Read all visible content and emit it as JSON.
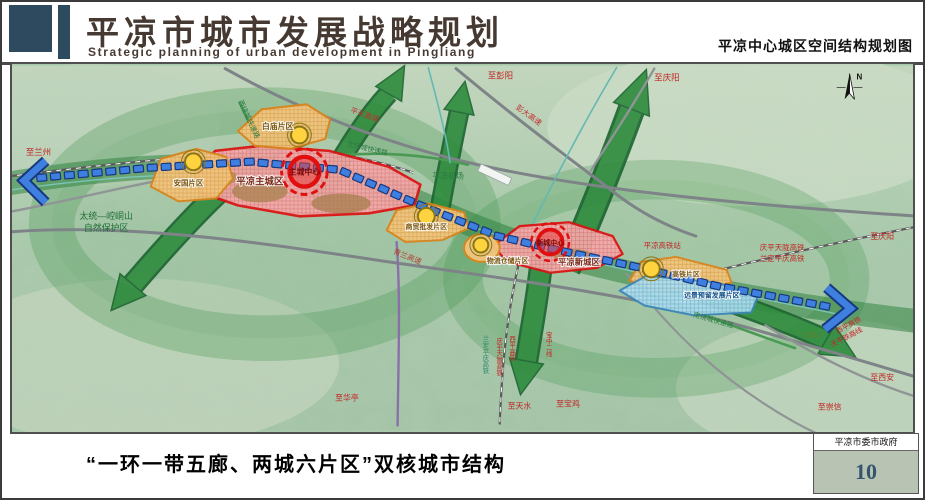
{
  "header": {
    "title": "平凉市城市发展战略规划",
    "subtitle": "Strategic planning of urban development in Pingliang",
    "right_caption": "平凉中心城区空间结构规划图"
  },
  "footer": {
    "caption": "“一环一带五廊、两城六片区”双核城市结构",
    "org": "平凉市委市政府",
    "page_number": "10"
  },
  "map": {
    "compass": "N",
    "zones": {
      "main_city": "平凉主城区",
      "main_core": "主城中心",
      "new_city": "平凉新城区",
      "new_core": "新城中心",
      "anguo": "安国片区",
      "baimiao": "白庙片区",
      "trade": "商贸批发片区",
      "logistics": "物流仓储片区",
      "hsr": "高铁片区",
      "reserve": "远景预留发展片区"
    },
    "labels": {
      "to_lanzhou": "至兰州",
      "nature_reserve_line1": "太统—崆峒山",
      "nature_reserve_line2": "自然保护区",
      "west_ring_road": "西绕城快速路",
      "pingtian_expwy": "平天高速",
      "north_ring_road": "北环城快速路",
      "airport": "平凉机场",
      "to_pengyang": "至彭阳",
      "pengda_expwy": "彭大高速",
      "to_qingyang_top": "至庆阳",
      "qinglan_expwy": "青兰高速",
      "hsr_station": "平凉高铁站",
      "south_ring_road": "南绕城快速路",
      "qptl_hsr": "庆平天陇高铁",
      "ldpq_hsr": "兰定平庆高铁",
      "to_qingyang_right": "至庆阳",
      "g312": "G312",
      "xiping_hsr": "西平高铁",
      "tianping_rail": "天平铁路线",
      "to_xian": "至西安",
      "to_chongxin": "至崇信",
      "to_huating": "至华亭",
      "s_ldpq_hsr": "兰定平庆高铁",
      "s_qptl_hsr": "庆平天陇高铁",
      "s_xiping_hsr": "西平高铁",
      "baozhong_line2": "宝中二线",
      "to_tianshui": "至天水",
      "to_baoji": "至宝鸡"
    }
  },
  "colors": {
    "accent_slate": "#2d4a5e",
    "title_brown": "#463931",
    "zone_red": "#dd1111",
    "zone_orange": "#d9851c",
    "corridor_green": "#2e8b3d",
    "transit_blue": "#3f7fe0",
    "page_number_blue": "#33566e"
  }
}
